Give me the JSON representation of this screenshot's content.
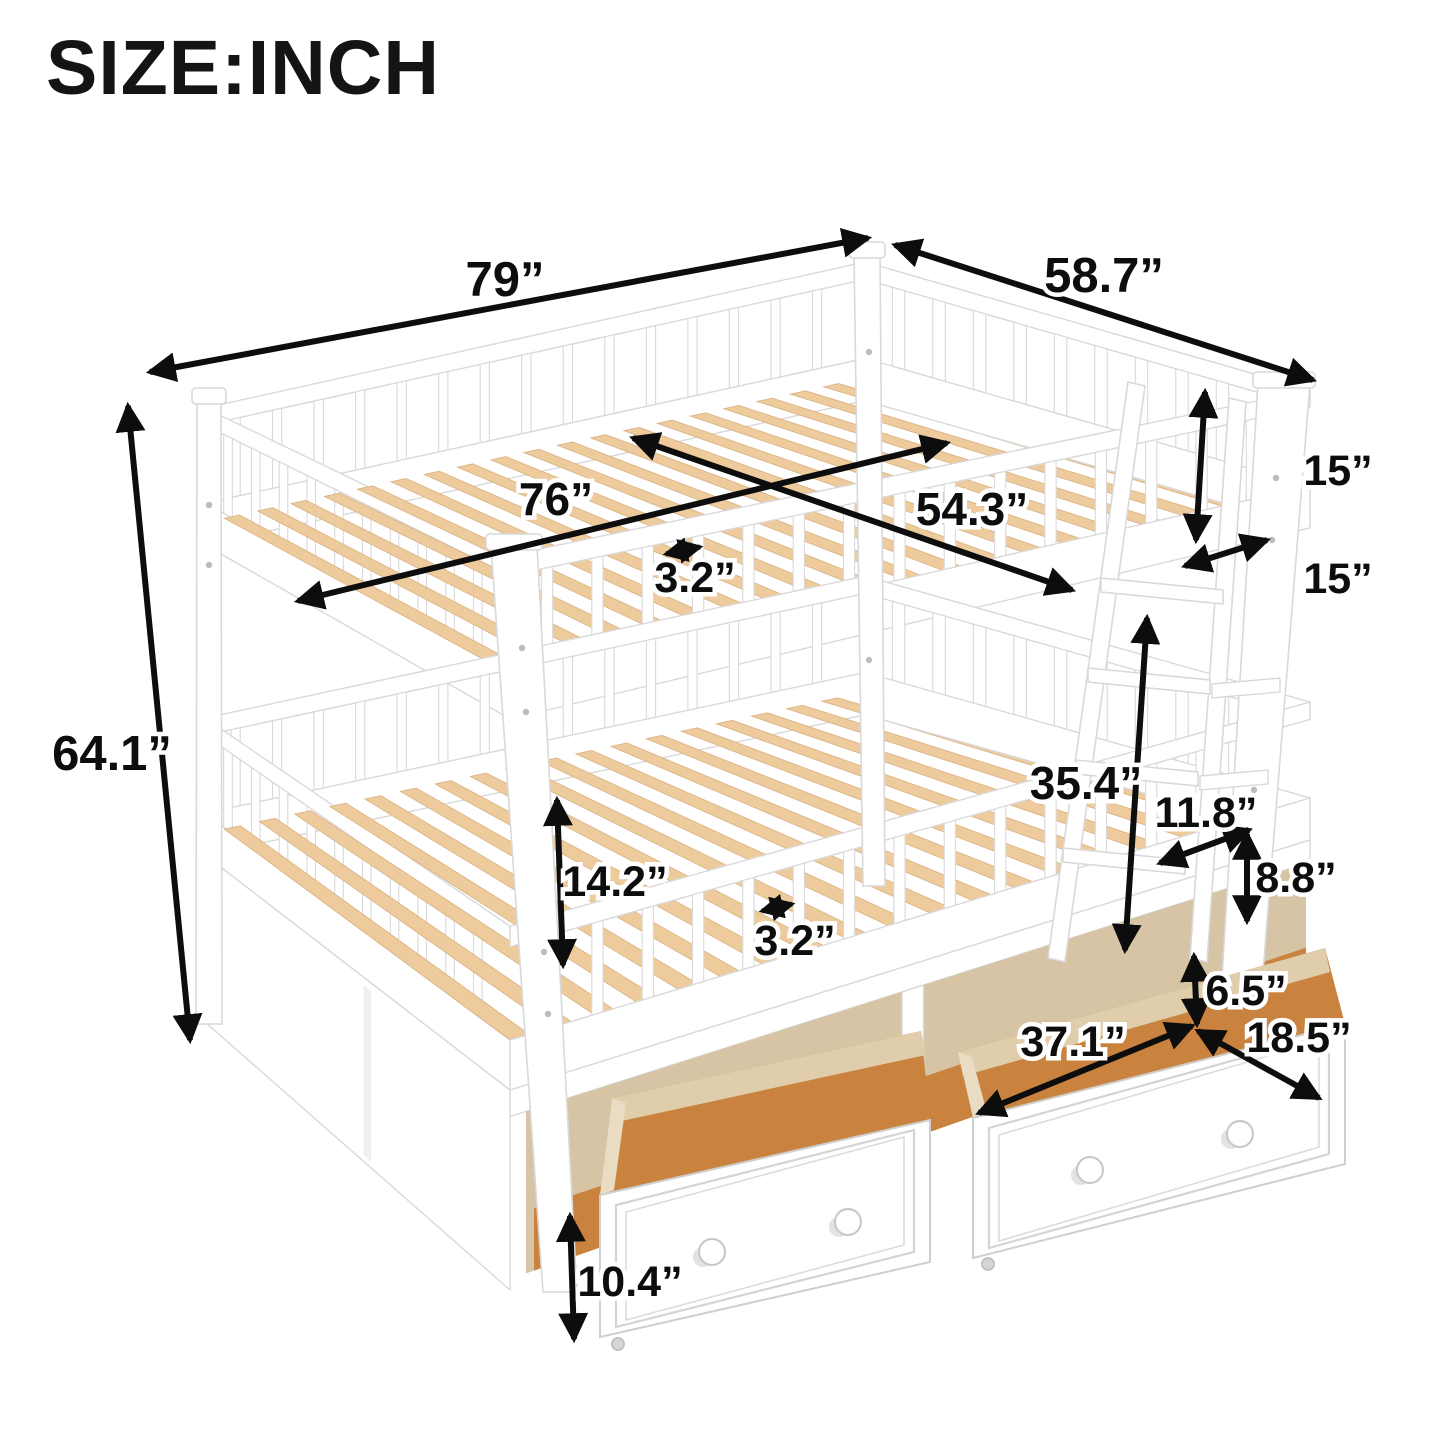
{
  "title": "SIZE:INCH",
  "dims": {
    "overall_length": "79”",
    "overall_width": "58.7”",
    "overall_height": "64.1”",
    "top_slat_length": "76”",
    "top_inner_width": "54.3”",
    "top_slat_gap": "3.2”",
    "top_rail_height": "15”",
    "rail_opening_width": "15”",
    "bottom_clearance": "14.2”",
    "bottom_slat_gap": "3.2”",
    "bunk_spacing": "35.4”",
    "ladder_step_length": "11.8”",
    "ladder_step_spacing": "8.8”",
    "drawer_top_gap": "6.5”",
    "drawer_length": "37.1”",
    "drawer_depth": "18.5”",
    "drawer_height": "10.4”"
  },
  "colors": {
    "frame": "#ffffff",
    "frame_line": "#d9d9d9",
    "slat": "#eecb9d",
    "slat_line": "#dcb485",
    "drawer_floor": "#c9833f",
    "cavity": "#d6c4a4",
    "wall_light": "#e9dcc2",
    "wall_mid": "#dfcdab",
    "arrow": "#0d0d0d"
  }
}
